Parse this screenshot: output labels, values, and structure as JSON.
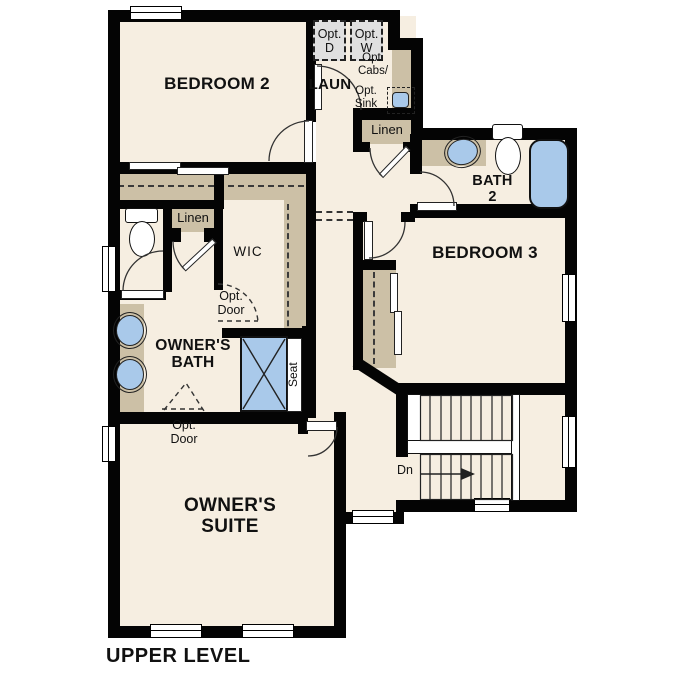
{
  "plan_title": "UPPER LEVEL",
  "colors": {
    "wall": "#040404",
    "floor": "#f6eee1",
    "casework_tan": "#ccc0a6",
    "appliance_gray": "#e0e0e0",
    "fixture_blue": "#a9c9ea",
    "background": "#ffffff"
  },
  "rooms": {
    "bedroom2": {
      "label": "BEDROOM 2"
    },
    "bedroom3": {
      "label": "BEDROOM 3"
    },
    "owners_suite": {
      "line1": "OWNER'S",
      "line2": "SUITE"
    },
    "owners_bath": {
      "line1": "OWNER'S",
      "line2": "BATH"
    },
    "bath2": {
      "line1": "BATH",
      "line2": "2"
    },
    "laundry": {
      "label": "LAUN"
    },
    "wic": {
      "label": "WIC"
    }
  },
  "closets": {
    "linen_hall": {
      "label": "Linen"
    },
    "linen_owner": {
      "label": "Linen"
    }
  },
  "annotations": {
    "opt_dryer": {
      "line1": "Opt.",
      "line2": "D"
    },
    "opt_washer": {
      "line1": "Opt.",
      "line2": "W"
    },
    "opt_cabs": {
      "line1": "Opt.",
      "line2": "Cabs/"
    },
    "opt_sink": {
      "line1": "Opt.",
      "line2": "Sink"
    },
    "opt_door_wic": {
      "line1": "Opt.",
      "line2": "Door"
    },
    "opt_door_owners_bath": {
      "line1": "Opt.",
      "line2": "Door"
    },
    "shower_seat": {
      "label": "Seat"
    },
    "stairs": {
      "label": "Dn"
    }
  },
  "icons": [
    "toilet-icon",
    "sink-icon",
    "bathtub-icon",
    "shower-icon",
    "washer-icon",
    "dryer-icon",
    "optional-sink-icon",
    "down-arrow-icon",
    "window",
    "door-leaf",
    "closet-rod",
    "stair-treads"
  ]
}
